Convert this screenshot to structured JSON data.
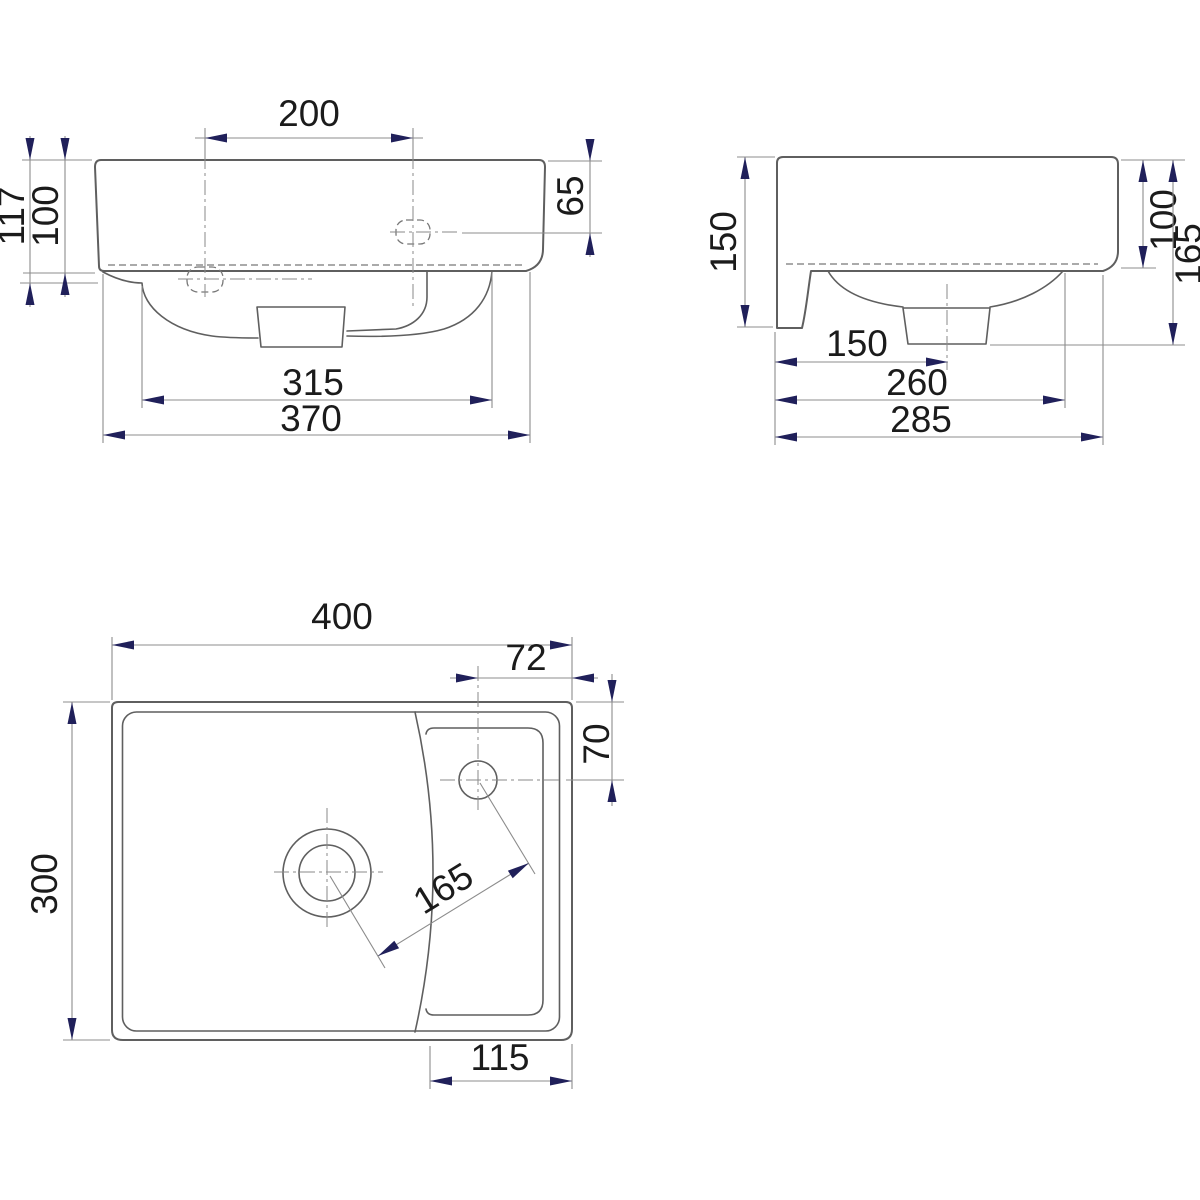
{
  "drawing": {
    "front_view": {
      "hole_spacing": "200",
      "hole_depth_from_top": "65",
      "height_total": "117",
      "height_body": "100",
      "bowl_width": "315",
      "overall_width": "370"
    },
    "side_view": {
      "height_with_flange": "150",
      "height_body": "100",
      "depth_with_trap": "165",
      "drain_from_wall": "150",
      "bowl_extent": "260",
      "overall_depth": "285"
    },
    "plan_view": {
      "overall_width": "400",
      "hole_from_right_edge": "72",
      "hole_from_back_edge": "70",
      "overall_depth": "300",
      "hole_diagonal_spacing": "165",
      "shelf_width": "115"
    },
    "colors": {
      "geometry_line": "#5f5f5f",
      "dimension_line": "#8c8c8c",
      "arrowhead": "#20205a",
      "text": "#1b1b1b",
      "background": "#ffffff"
    }
  }
}
